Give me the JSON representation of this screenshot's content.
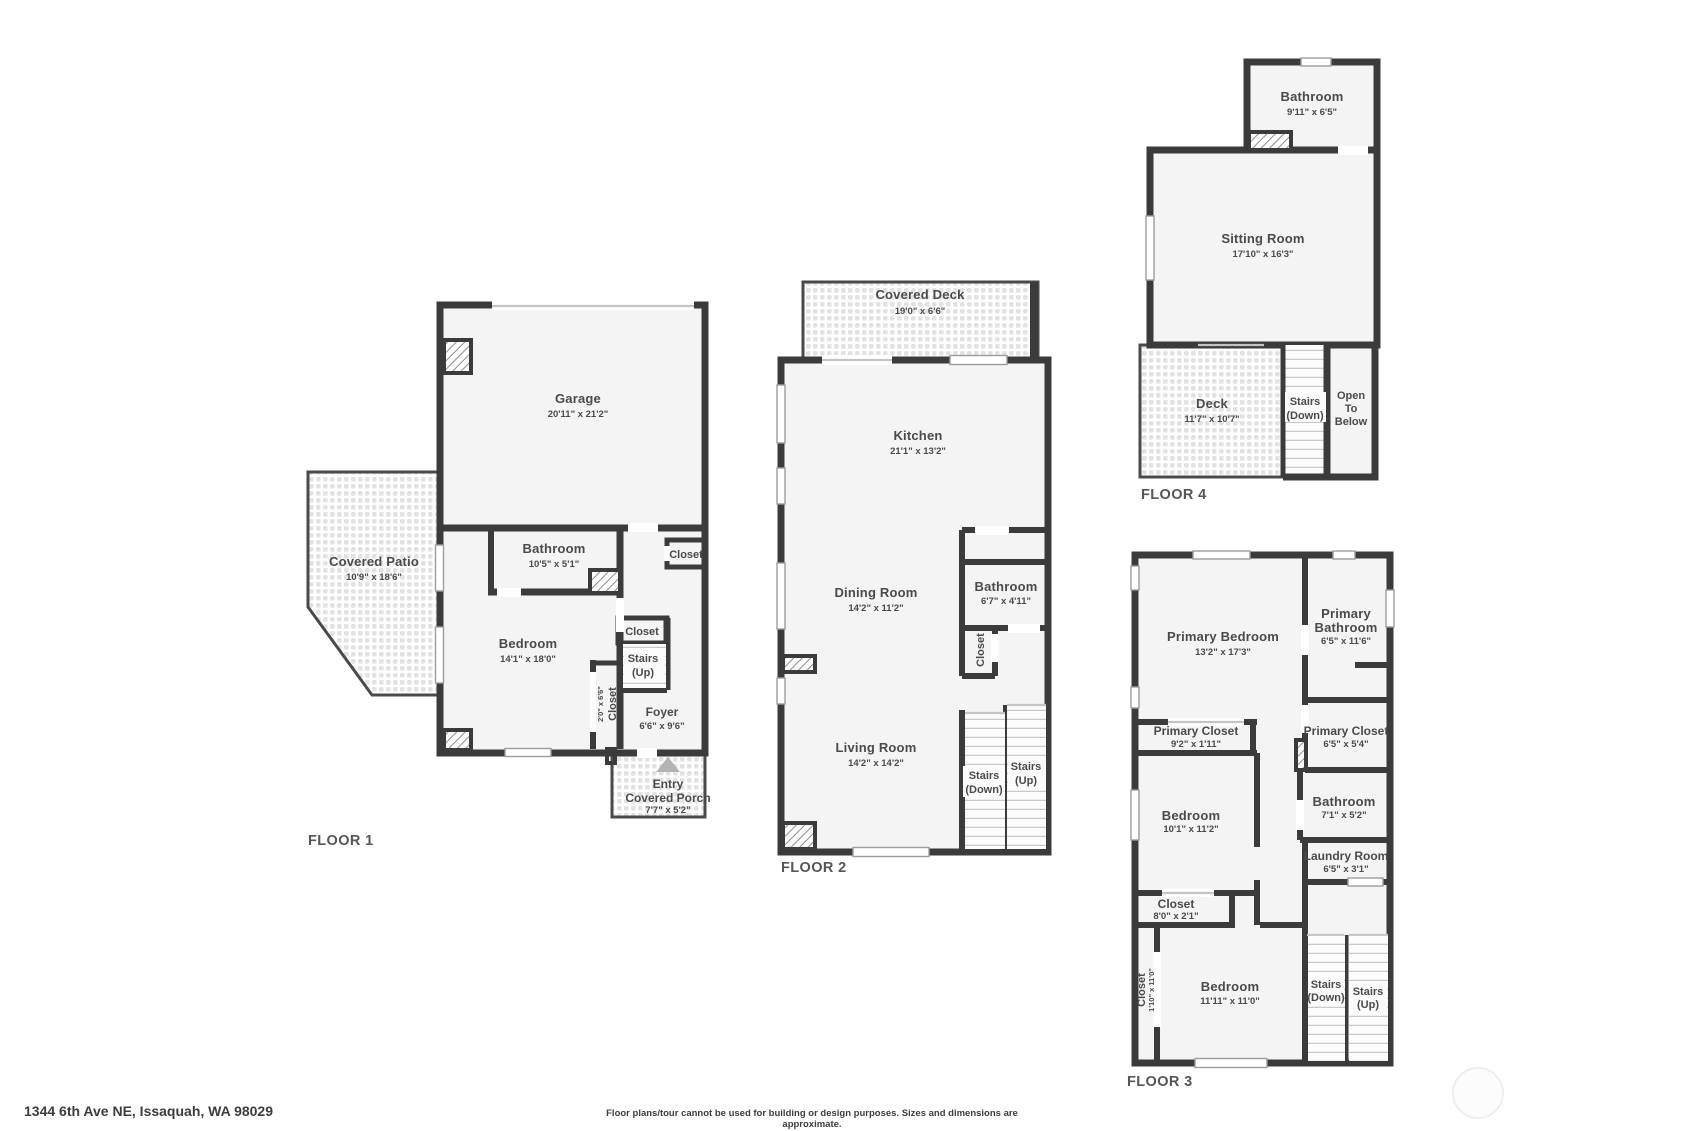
{
  "footer": {
    "address": "1344 6th Ave NE, Issaquah, WA 98029",
    "disclaimer": "Floor plans/tour cannot be used for building or design purposes. Sizes and dimensions are approximate."
  },
  "colors": {
    "wall": "#3b3b3b",
    "room_fill": "#f4f4f4",
    "label_text": "#4a4a4a",
    "floor_label": "#565656"
  },
  "floor1": {
    "label": "FLOOR 1",
    "garage": {
      "name": "Garage",
      "dims": "20'11\" x 21'2\""
    },
    "covered_patio": {
      "name": "Covered Patio",
      "dims": "10'9\" x 18'6\""
    },
    "bathroom": {
      "name": "Bathroom",
      "dims": "10'5\" x 5'1\""
    },
    "closet_hall": {
      "name": "Closet"
    },
    "bedroom": {
      "name": "Bedroom",
      "dims": "14'1\" x 18'0\""
    },
    "closet_bedroom": {
      "name": "Closet",
      "dims": "2'0\" x 6'6\""
    },
    "closet_stairs": {
      "name": "Closet"
    },
    "stairs_up": {
      "line1": "Stairs",
      "line2": "(Up)"
    },
    "foyer": {
      "name": "Foyer",
      "dims": "6'6\" x 9'6\""
    },
    "porch": {
      "line1": "Entry",
      "line2": "Covered Porch",
      "dims": "7'7\" x 5'2\""
    }
  },
  "floor2": {
    "label": "FLOOR 2",
    "covered_deck": {
      "name": "Covered Deck",
      "dims": "19'0\" x 6'6\""
    },
    "kitchen": {
      "name": "Kitchen",
      "dims": "21'1\" x 13'2\""
    },
    "dining_room": {
      "name": "Dining Room",
      "dims": "14'2\" x 11'2\""
    },
    "bathroom": {
      "name": "Bathroom",
      "dims": "6'7\" x 4'11\""
    },
    "closet": {
      "name": "Closet"
    },
    "living_room": {
      "name": "Living Room",
      "dims": "14'2\" x 14'2\""
    },
    "stairs_down": {
      "line1": "Stairs",
      "line2": "(Down)"
    },
    "stairs_up": {
      "line1": "Stairs",
      "line2": "(Up)"
    }
  },
  "floor3": {
    "label": "FLOOR 3",
    "primary_bedroom": {
      "name": "Primary Bedroom",
      "dims": "13'2\" x 17'3\""
    },
    "primary_bathroom": {
      "line1": "Primary",
      "line2": "Bathroom",
      "dims": "6'5\" x 11'6\""
    },
    "primary_closet_left": {
      "name": "Primary Closet",
      "dims": "9'2\" x 1'11\""
    },
    "primary_closet_right": {
      "name": "Primary Closet",
      "dims": "6'5\" x 5'4\""
    },
    "bedroom_mid": {
      "name": "Bedroom",
      "dims": "10'1\" x 11'2\""
    },
    "bathroom": {
      "name": "Bathroom",
      "dims": "7'1\" x 5'2\""
    },
    "laundry_room": {
      "name": "Laundry Room",
      "dims": "6'5\" x 3'1\""
    },
    "closet_mid": {
      "name": "Closet",
      "dims": "8'0\" x 2'1\""
    },
    "closet_tall": {
      "name": "Closet",
      "dims": "1'10\" x 11'0\""
    },
    "bedroom_lower": {
      "name": "Bedroom",
      "dims": "11'11\" x 11'0\""
    },
    "stairs_down": {
      "line1": "Stairs",
      "line2": "(Down)"
    },
    "stairs_up": {
      "line1": "Stairs",
      "line2": "(Up)"
    }
  },
  "floor4": {
    "label": "FLOOR 4",
    "bathroom": {
      "name": "Bathroom",
      "dims": "9'11\" x 6'5\""
    },
    "sitting_room": {
      "name": "Sitting Room",
      "dims": "17'10\" x 16'3\""
    },
    "deck": {
      "name": "Deck",
      "dims": "11'7\" x 10'7\""
    },
    "stairs_down": {
      "line1": "Stairs",
      "line2": "(Down)"
    },
    "open_to_below": {
      "line1": "Open",
      "line2": "To",
      "line3": "Below"
    }
  }
}
